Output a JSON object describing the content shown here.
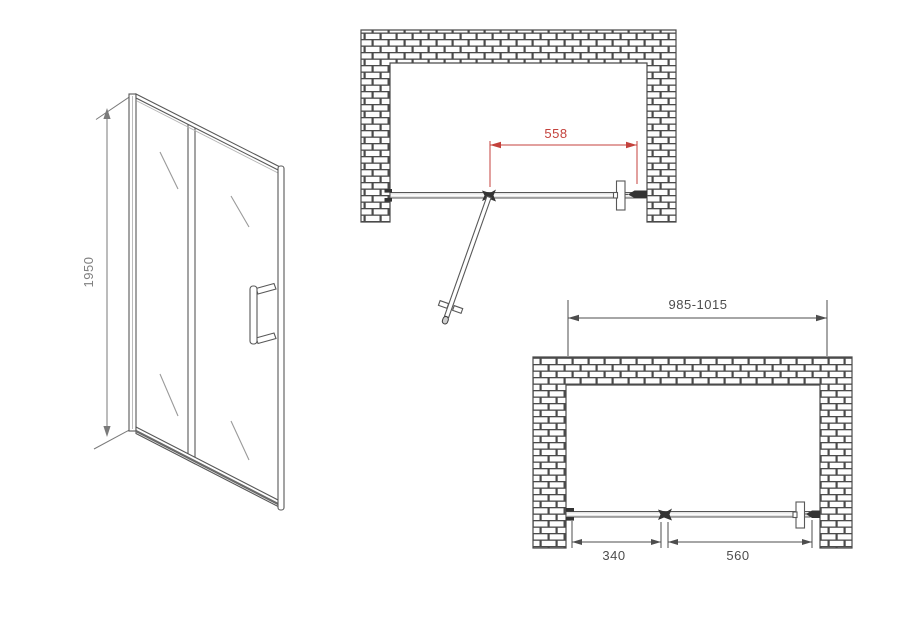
{
  "drawing": {
    "front_view": {
      "height": "1950"
    },
    "plan_open_view": {
      "door_opening_width": "558"
    },
    "plan_closed_view": {
      "overall_width_range": "985-1015",
      "fixed_segment_width": "340",
      "door_segment_width": "560"
    },
    "colors": {
      "linework": "#585858",
      "dimension_gray": "#7a7a7a",
      "dimension_dark": "#4d4d4d",
      "dimension_red": "#c4423c",
      "glass_fill": "#e4e4e4"
    }
  }
}
